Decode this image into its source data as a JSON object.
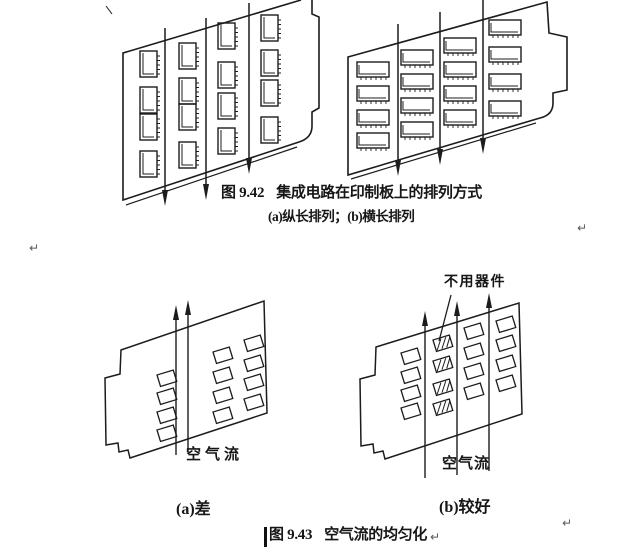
{
  "figure_942": {
    "caption_label": "图 9.42",
    "caption_text": "集成电路在印制板上的排列方式",
    "subcaption": "(a)纵长排列；(b)横长排列"
  },
  "figure_943": {
    "unused_label": "不用器件",
    "airflow_left": "空气流",
    "airflow_right": "空气流",
    "poor_label": "(a)差",
    "better_label": "(b)较好",
    "caption_label": "图 9.43",
    "caption_text": "空气流的均匀化"
  },
  "marks": {
    "return_mark": "↵"
  },
  "colors": {
    "ink": "#1c1c1c",
    "background": "#ffffff"
  }
}
